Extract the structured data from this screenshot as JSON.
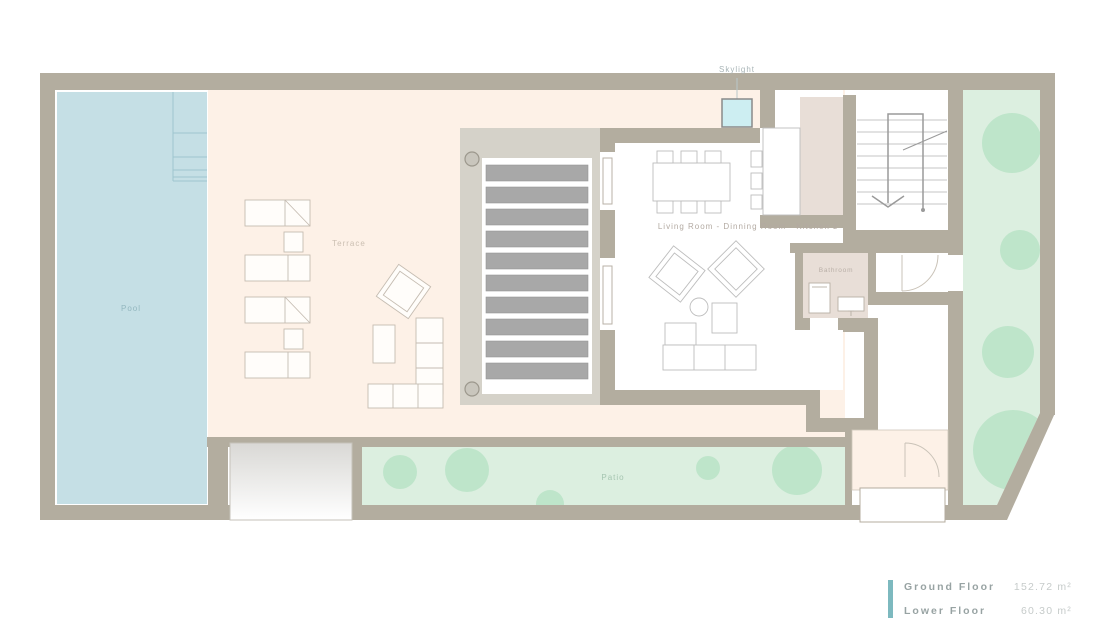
{
  "plan": {
    "skylight_label": "Skylight",
    "terrace_label": "Terrace",
    "pool_label": "Pool",
    "living_label": "Living Room - Dinning Room - Kitchen z",
    "bathroom_label": "Bathroom",
    "patio_label": "Patio"
  },
  "legend": {
    "rows": [
      {
        "label": "Ground Floor",
        "value": "152.72 m²"
      },
      {
        "label": "Lower Floor",
        "value": "60.30 m²"
      }
    ],
    "accent_color": "#7db9bf"
  },
  "palette": {
    "wall": "#b3ad9f",
    "terrace": "#fdf1e7",
    "pool": "#c5dfe5",
    "deck": "#d5d2c9",
    "deck_slat": "#a8a8a8",
    "garden": "#dcefe0",
    "tree": "#bee5ca",
    "interior": "#ffffff",
    "utility_pink": "#e8ded7",
    "skylight": "#cdeef2"
  }
}
